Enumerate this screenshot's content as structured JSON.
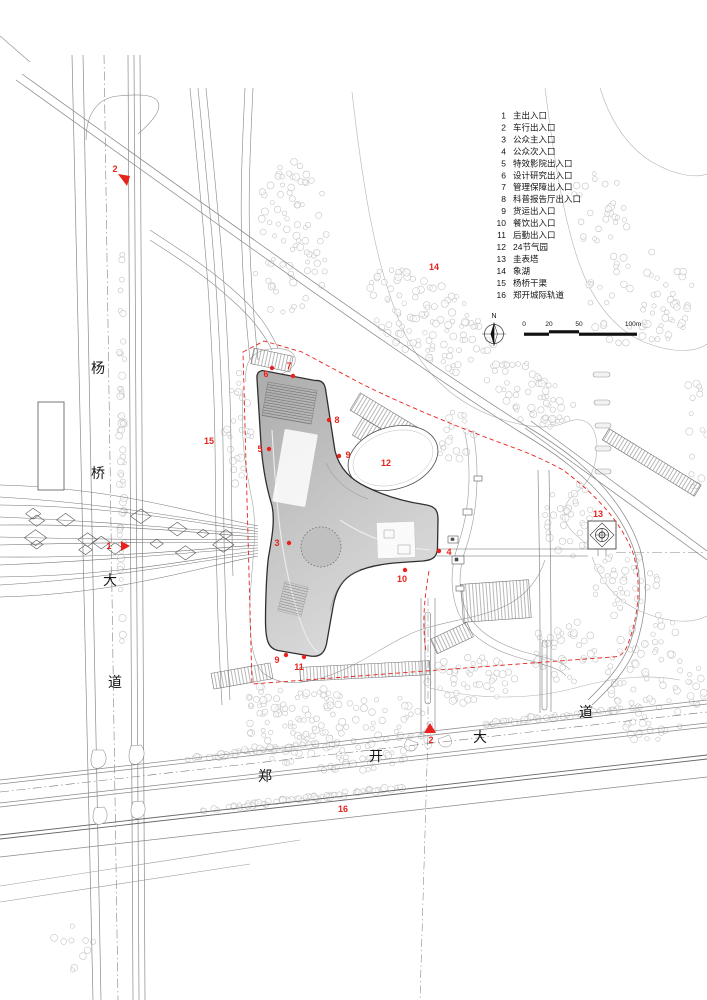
{
  "drawing": {
    "type": "architectural-site-plan",
    "colors": {
      "red": "#e8231d",
      "line_light": "#9a9a9a",
      "line_dark": "#2f2f2f",
      "tree": "#c4c4c4",
      "text": "#141414",
      "building_fill_from": "#aeaeae",
      "building_fill_to": "#dcdcdc"
    }
  },
  "legend": {
    "items": [
      {
        "num": "1",
        "label": "主出入口"
      },
      {
        "num": "2",
        "label": "车行出入口"
      },
      {
        "num": "3",
        "label": "公众主入口"
      },
      {
        "num": "4",
        "label": "公众次入口"
      },
      {
        "num": "5",
        "label": "特效影院出入口"
      },
      {
        "num": "6",
        "label": "设计研究出入口"
      },
      {
        "num": "7",
        "label": "管理保障出入口"
      },
      {
        "num": "8",
        "label": "科普报告厅出入口"
      },
      {
        "num": "9",
        "label": "货运出入口"
      },
      {
        "num": "10",
        "label": "餐饮出入口"
      },
      {
        "num": "11",
        "label": "后勤出入口"
      },
      {
        "num": "12",
        "label": "24节气园"
      },
      {
        "num": "13",
        "label": "圭表塔"
      },
      {
        "num": "14",
        "label": "象湖"
      },
      {
        "num": "15",
        "label": "杨桥干渠"
      },
      {
        "num": "16",
        "label": "郑开城际轨道"
      }
    ],
    "x_num": 506,
    "x_label": 513,
    "y_start": 118.5,
    "y_step": 11.95,
    "font_size": 8.5
  },
  "scale_bar": {
    "north_label": "N",
    "ticks": [
      "0",
      "20",
      "50",
      "100m"
    ],
    "tick_x": [
      524,
      549,
      579,
      633
    ]
  },
  "road_labels": [
    {
      "id": "yangqiao-1",
      "ch": "杨",
      "x": 98,
      "y": 373
    },
    {
      "id": "yangqiao-2",
      "ch": "桥",
      "x": 98,
      "y": 478
    },
    {
      "id": "yangqiao-3",
      "ch": "大",
      "x": 110,
      "y": 585
    },
    {
      "id": "yangqiao-4",
      "ch": "道",
      "x": 115,
      "y": 687
    },
    {
      "id": "zhengkai-1",
      "ch": "郑",
      "x": 265,
      "y": 781
    },
    {
      "id": "zhengkai-2",
      "ch": "开",
      "x": 376,
      "y": 761
    },
    {
      "id": "zhengkai-3",
      "ch": "大",
      "x": 480,
      "y": 742
    },
    {
      "id": "zhengkai-4",
      "ch": "道",
      "x": 586,
      "y": 717
    }
  ],
  "markers": [
    {
      "n": "1",
      "tx": 109,
      "ty": 549,
      "shape": "tri-right",
      "sx": 121,
      "sy": 546
    },
    {
      "n": "2",
      "tx": 115,
      "ty": 172,
      "shape": "tri-down",
      "sx": 124,
      "sy": 180
    },
    {
      "n": "2",
      "tx": 431,
      "ty": 743,
      "shape": "tri-up",
      "sx": 430,
      "sy": 729
    },
    {
      "n": "3",
      "tx": 277,
      "ty": 546,
      "shape": "dot",
      "sx": 289,
      "sy": 543
    },
    {
      "n": "4",
      "tx": 449,
      "ty": 555,
      "shape": "dot",
      "sx": 439,
      "sy": 551
    },
    {
      "n": "5",
      "tx": 260,
      "ty": 452,
      "shape": "dot",
      "sx": 269,
      "sy": 449
    },
    {
      "n": "6",
      "tx": 266,
      "ty": 377,
      "shape": "dot",
      "sx": 272,
      "sy": 368
    },
    {
      "n": "7",
      "tx": 289,
      "ty": 369,
      "shape": "dot",
      "sx": 293,
      "sy": 376
    },
    {
      "n": "8",
      "tx": 337,
      "ty": 423,
      "shape": "dot",
      "sx": 329,
      "sy": 420
    },
    {
      "n": "9",
      "tx": 348,
      "ty": 458,
      "shape": "dot",
      "sx": 339,
      "sy": 456
    },
    {
      "n": "10",
      "tx": 402,
      "ty": 582,
      "shape": "dot",
      "sx": 405,
      "sy": 570
    },
    {
      "n": "9",
      "tx": 277,
      "ty": 663,
      "shape": "dot",
      "sx": 286,
      "sy": 655
    },
    {
      "n": "11",
      "tx": 299,
      "ty": 670,
      "shape": "dot",
      "sx": 304,
      "sy": 657
    },
    {
      "n": "12",
      "tx": 386,
      "ty": 466,
      "shape": "none"
    },
    {
      "n": "13",
      "tx": 598,
      "ty": 517,
      "shape": "none"
    },
    {
      "n": "14",
      "tx": 434,
      "ty": 270,
      "shape": "none"
    },
    {
      "n": "15",
      "tx": 209,
      "ty": 444,
      "shape": "none"
    },
    {
      "n": "16",
      "tx": 343,
      "ty": 812,
      "shape": "none"
    }
  ],
  "tree_clusters": [
    {
      "cx": 290,
      "cy": 240,
      "rx": 40,
      "ry": 80,
      "n": 80
    },
    {
      "cx": 430,
      "cy": 322,
      "rx": 75,
      "ry": 38,
      "n": 110,
      "rot": 35
    },
    {
      "cx": 530,
      "cy": 395,
      "rx": 50,
      "ry": 28,
      "n": 60,
      "rot": 32
    },
    {
      "cx": 640,
      "cy": 300,
      "rx": 55,
      "ry": 50,
      "n": 65
    },
    {
      "cx": 600,
      "cy": 210,
      "rx": 30,
      "ry": 40,
      "n": 28
    },
    {
      "cx": 570,
      "cy": 520,
      "rx": 28,
      "ry": 38,
      "n": 36
    },
    {
      "cx": 625,
      "cy": 585,
      "rx": 35,
      "ry": 33,
      "n": 38
    },
    {
      "cx": 655,
      "cy": 680,
      "rx": 50,
      "ry": 68,
      "n": 85
    },
    {
      "cx": 565,
      "cy": 650,
      "rx": 35,
      "ry": 33,
      "n": 38
    },
    {
      "cx": 340,
      "cy": 730,
      "rx": 95,
      "ry": 42,
      "n": 150
    },
    {
      "cx": 470,
      "cy": 680,
      "rx": 45,
      "ry": 25,
      "n": 45
    },
    {
      "cx": 238,
      "cy": 430,
      "rx": 14,
      "ry": 60,
      "n": 26
    },
    {
      "cx": 270,
      "cy": 700,
      "rx": 28,
      "ry": 16,
      "n": 22
    },
    {
      "cx": 455,
      "cy": 435,
      "rx": 22,
      "ry": 25,
      "n": 20
    },
    {
      "cx": 122,
      "cy": 450,
      "rx": 3,
      "ry": 215,
      "n": 58
    },
    {
      "cx": 255,
      "cy": 751,
      "rx": 75,
      "ry": 2.5,
      "n": 48,
      "rot": -6.5
    },
    {
      "cx": 560,
      "cy": 716,
      "rx": 85,
      "ry": 2.5,
      "n": 55,
      "rot": -6.5
    },
    {
      "cx": 300,
      "cy": 799,
      "rx": 115,
      "ry": 2.5,
      "n": 70,
      "rot": -6.5
    },
    {
      "cx": 75,
      "cy": 950,
      "rx": 25,
      "ry": 28,
      "n": 10
    },
    {
      "cx": 697,
      "cy": 420,
      "rx": 10,
      "ry": 80,
      "n": 15
    }
  ]
}
